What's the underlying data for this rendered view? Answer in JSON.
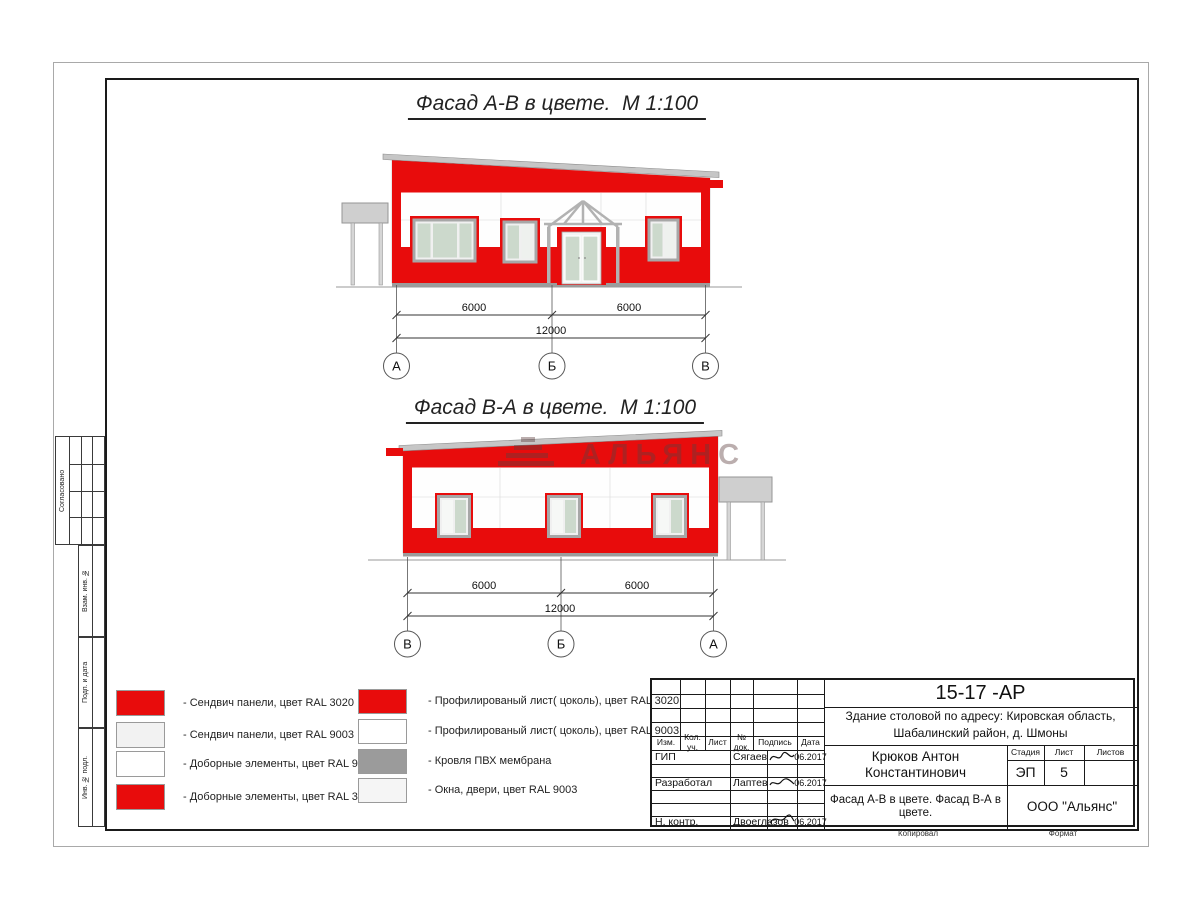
{
  "colors": {
    "panel_red": "#e80c0c",
    "glass_green": "#ccd9cc",
    "frame_gray": "#a7a7a7",
    "canopy_gray": "#cfcfcf",
    "roof_gray": "#c6c6c6"
  },
  "facade1": {
    "title": "Фасад А-В в цвете.  М 1:100",
    "dims": {
      "left": "6000",
      "right": "6000",
      "total": "12000"
    },
    "axes": [
      "А",
      "Б",
      "В"
    ]
  },
  "facade2": {
    "title": "Фасад В-А в цвете.  М 1:100",
    "dims": {
      "left": "6000",
      "right": "6000",
      "total": "12000"
    },
    "axes": [
      "В",
      "Б",
      "А"
    ],
    "watermark": "АЛЬЯНС"
  },
  "legend": {
    "col1": [
      {
        "color": "#e80c0c",
        "label": "- Сендвич панели, цвет RAL 3020"
      },
      {
        "color": "#f2f2f2",
        "label": "- Сендвич панели, цвет RAL 9003"
      },
      {
        "color": "#ffffff",
        "label": "- Доборные элементы, цвет RAL 9003"
      },
      {
        "color": "#e80c0c",
        "label": "- Доборные элементы, цвет RAL 3020"
      }
    ],
    "col2": [
      {
        "color": "#e80c0c",
        "label": "- Профилированый лист( цоколь), цвет RAL 3020"
      },
      {
        "color": "#ffffff",
        "label": "- Профилированый лист( цоколь), цвет RAL 9003"
      },
      {
        "color": "#9b9b9b",
        "label": "- Кровля ПВХ мембрана"
      },
      {
        "color": "#f5f5f5",
        "label": "- Окна, двери, цвет RAL 9003"
      }
    ]
  },
  "titleblock": {
    "code": "15-17 -АР",
    "project_line1": "Здание столовой по адресу: Кировская область,",
    "project_line2": "Шабалинский район, д. Шмоны",
    "person": "Крюков Антон Константинович",
    "sheet_title": "Фасад А-В в цвете. Фасад В-А в цвете.",
    "company": "ООО \"Альянс\"",
    "stage_label": "Стадия",
    "sheet_label": "Лист",
    "sheets_label": "Листов",
    "stage_value": "ЭП",
    "sheet_value": "5",
    "cols": [
      "Изм.",
      "Кол. уч.",
      "Лист",
      "№ док.",
      "Подпись",
      "Дата"
    ],
    "rows": [
      {
        "role": "ГИП",
        "name": "Сягаев",
        "date": "06.2017"
      },
      {
        "role": "Разработал",
        "name": "Лаптев",
        "date": "06.2017"
      },
      {
        "role": "Н. контр.",
        "name": "Двоеглазов",
        "date": "06.2017"
      }
    ],
    "copied_label": "Копировал",
    "format_label": "Формат"
  },
  "margin_labels": {
    "agreed": "Согласовано",
    "vzam": "Взам. инв. №",
    "podp": "Подп. и дата",
    "inv": "Инв. № подл."
  }
}
